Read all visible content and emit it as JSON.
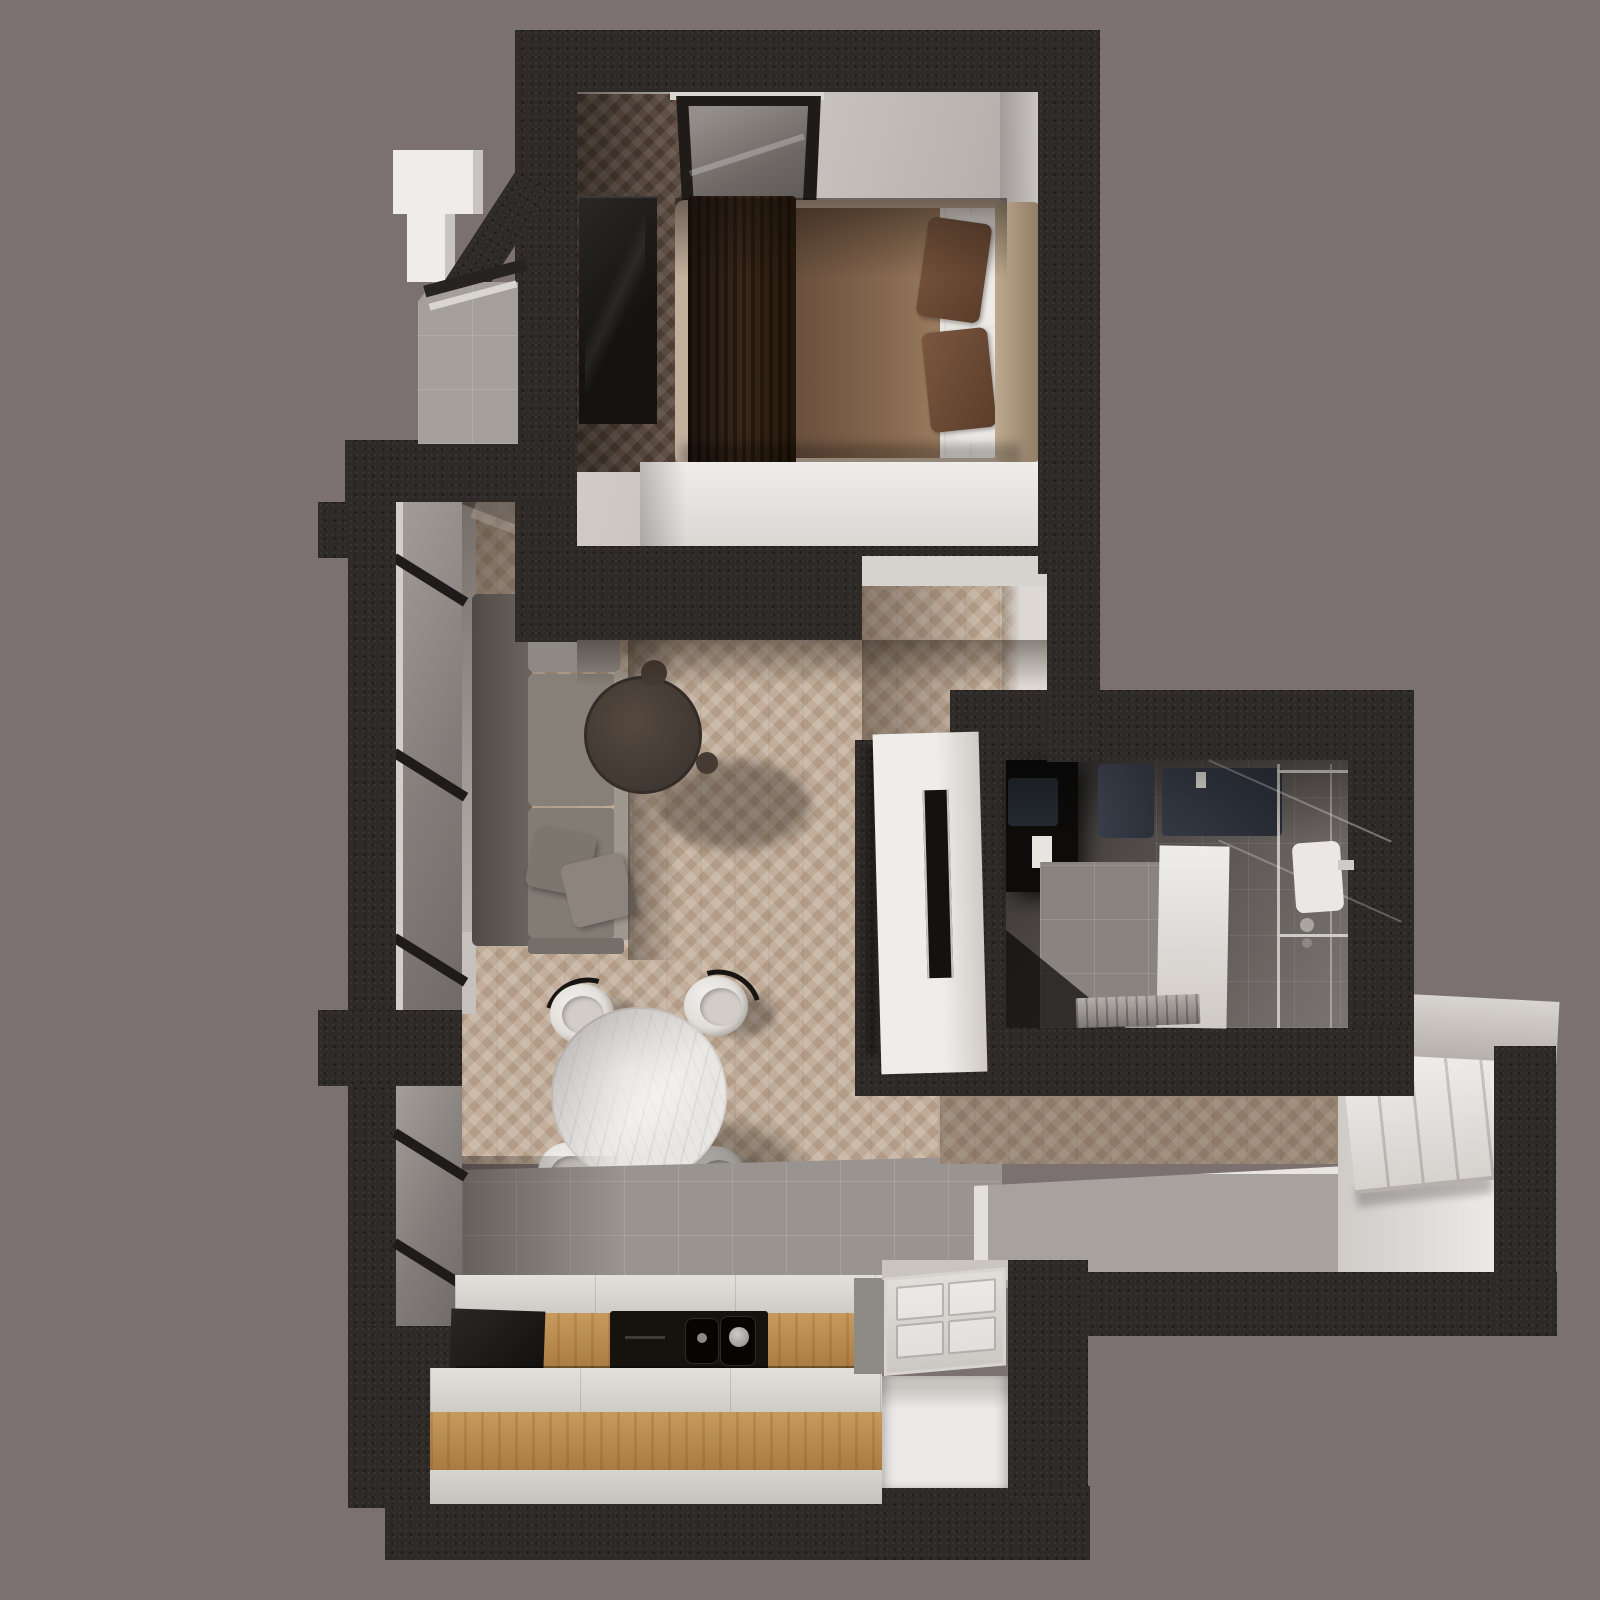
{
  "scene": {
    "kind": "3d-rendered-floor-plan",
    "view": "top-down axonometric",
    "rooms": [
      "bedroom",
      "living-room",
      "dining-area",
      "kitchen",
      "bathroom",
      "hallway",
      "balcony"
    ],
    "furniture": {
      "bedroom": [
        "double-bed",
        "brown-blanket",
        "dark-throw",
        "brown-pillows",
        "white-pillows",
        "tan-headboard",
        "dark-wardrobe",
        "window",
        "white-foot-bench"
      ],
      "living_room": [
        "gray-sofa",
        "sofa-cushions",
        "round-coffee-table",
        "tv-panel",
        "wall-mounted-tv",
        "floor-to-ceiling-windows"
      ],
      "dining_area": [
        "round-marble-table",
        "white-shell-chair",
        "white-shell-chair",
        "white-shell-chair",
        "white-shell-chair"
      ],
      "kitchen": [
        "oak-counter-with-black-sink",
        "oak-island-counter",
        "black-cooktop-panel",
        "faucet-dials"
      ],
      "bathroom": [
        "dark-vanity-units",
        "walk-in-shower",
        "glass-partition",
        "towel-radiator",
        "shower-tray-with-drain",
        "dark-wall-tiles"
      ],
      "hallway": [
        "white-paneled-wardrobe",
        "entry-door",
        "raised-gray-platform"
      ],
      "balcony": [
        "white-parapet",
        "railing",
        "gray-tile-floor"
      ]
    }
  },
  "palette": {
    "bg": "#7b7170",
    "wall": "#2e2a28",
    "wood_floor": "#c2ae9a",
    "wood_floor_dark": "#7a6557",
    "tile_gray": "#9a9490",
    "surface_white": "#eceae7",
    "counter_white": "#dcd8d4",
    "cabinet_wood": "#b8894f",
    "appliance_black": "#16130f",
    "sofa_gray": "#868079",
    "coffee_table_brown": "#463d35",
    "marble": "#e9e7e4",
    "bed_blanket_brown": "#86684f",
    "bed_throw_dark": "#2a1c11",
    "pillow_brown": "#6f4d39",
    "linen_white": "#e9e6e2",
    "headboard_tan": "#b09a82",
    "bathroom_tile_dark": "#5a5553",
    "vanity_navy": "#343a44",
    "chrome": "#d8d4d0",
    "glass_gray": "#8f8a87",
    "platform_gray": "#a8a29e"
  }
}
